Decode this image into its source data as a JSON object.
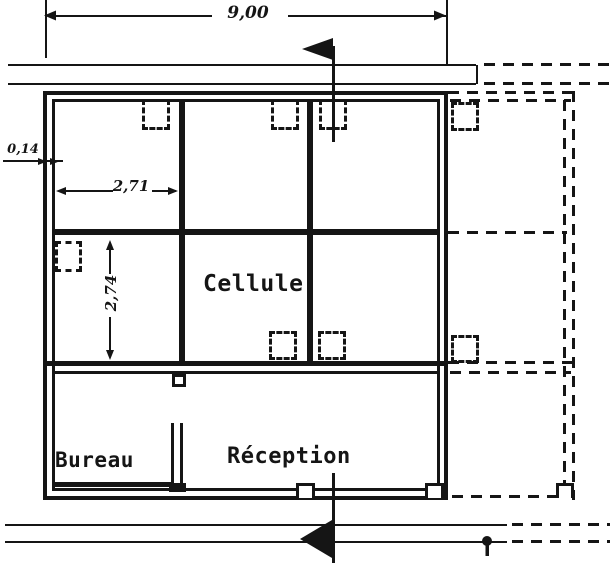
{
  "colors": {
    "ink": "#151515",
    "paper": "#ffffff"
  },
  "rooms": {
    "cellule": "Cellule",
    "bureau": "Bureau",
    "reception": "Réception"
  },
  "dimensions": {
    "overall_width_m": "9,00",
    "cell_width_m": "2,71",
    "cell_depth_m": "2,74",
    "wall_thickness_m": "0,14"
  }
}
